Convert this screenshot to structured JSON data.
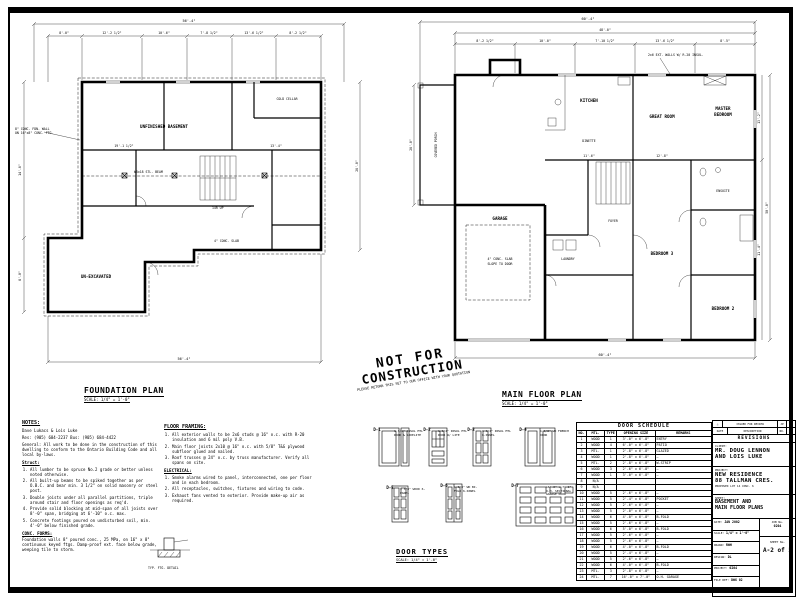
{
  "stamp": {
    "line1": "NOT FOR",
    "line2": "CONSTRUCTION",
    "sub": "PLEASE RETURN THIS SET TO OUR OFFICE WITH YOUR QUOTATION"
  },
  "foundation_plan": {
    "title": "FOUNDATION PLAN",
    "scale": "SCALE: 1/4\" = 1'-0\"",
    "dim_overall": "56'-4\"",
    "dim_left_top": "8'-0\"",
    "dims_top": [
      "12'-2 1/2\"",
      "10'-6\"",
      "7'-8 1/2\"",
      "13'-6 1/2\"",
      "8'-2 1/2\""
    ],
    "dim_left1": "14'-6\"",
    "dim_left2": "8'-0\"",
    "dim_right": "26'-0\"",
    "dim_bottom": "56'-4\"",
    "dims_in": [
      "19'-1 1/2\"",
      "13'-4\""
    ],
    "labels": {
      "basement": "UNFINISHED BASEMENT",
      "cold": "COLD CELLAR",
      "unexc": "UN-EXCAVATED",
      "fdn1": "8\" CONC. FDN. WALL",
      "fdn2": "ON 16\"x8\" CONC. FTG.",
      "beam": "W8x18 STL. BEAM",
      "stair": "14R UP",
      "slab": "4\" CONC. SLAB"
    }
  },
  "main_plan": {
    "title": "MAIN FLOOR PLAN",
    "scale": "SCALE: 1/4\" = 1'-0\"",
    "dim_overall": "60'-4\"",
    "dim_second": "48'-0\"",
    "dims_top": [
      "8'-2 1/2\"",
      "10'-0\"",
      "7'-10 1/2\"",
      "13'-6 1/2\"",
      "8'-5\""
    ],
    "dim_left": "26'-0\"",
    "dim_right": "50'-0\"",
    "dims_right_in": [
      "13'-2\"",
      "11'-4\""
    ],
    "dim_bottom": "60'-4\"",
    "dims_in": [
      "11'-6\"",
      "12'-8\""
    ],
    "labels": {
      "garage": "GARAGE",
      "kitchen": "KITCHEN",
      "dinette": "DINETTE",
      "great": "GREAT ROOM",
      "master1": "MASTER",
      "master2": "BEDROOM",
      "ens": "ENSUITE",
      "bed2": "BEDROOM 2",
      "bed3": "BEDROOM 3",
      "laun": "LAUNDRY",
      "foyer": "FOYER",
      "porch": "COVERED PORCH",
      "slab1": "4\" CONC. SLAB",
      "slab2": "SLOPE TO DOOR",
      "wall_note": "2x6 EXT. WALLS W/ R-20 INSUL."
    }
  },
  "notes": {
    "heading": "NOTES:",
    "intro1": "Dave Lukacs & Lois Luke",
    "intro2": "Res: (905) 684-2237   Bus: (905) 684-4422",
    "general": "General:  All work to be done in the construction of this dwelling to conform to the Ontario Building Code and all local by-laws.",
    "struct_label": "Struct:",
    "items": [
      "All lumber to be spruce No.2 grade or better unless noted otherwise.",
      "All built-up beams to be spiked together as per O.B.C. and bear min. 3 1/2\" on solid masonry or steel post.",
      "Double joists under all parallel partitions, triple around stair and floor openings as req'd.",
      "Provide solid blocking at mid-span of all joists over 8'-0\" span, bridging at 6'-10\" o.c. max.",
      "Concrete footings poured on undisturbed soil, min. 4'-0\" below finished grade."
    ],
    "forms_label": "CONC. FORMS:",
    "forms": "Foundation walls 8\" poured conc., 25 MPa, on 16\" x 8\" continuous keyed ftgs. Damp-proof ext. face below grade, weeping tile to storm."
  },
  "notes2": {
    "heading": "FLOOR FRAMING:",
    "items": [
      "All exterior walls to be 2x6 studs @ 16\" o.c. with R-20 insulation and 6 mil poly V.B.",
      "Main floor joists 2x10 @ 16\" o.c. with 5/8\" T&G plywood subfloor glued and nailed.",
      "Roof trusses @ 24\" o.c. by truss manufacturer. Verify all spans on site."
    ],
    "elec_label": "ELECTRICAL:",
    "elec_items": [
      "Smoke alarms wired to panel, interconnected, one per floor and in each bedroom.",
      "All receptacles, switches, fixtures and wiring to code.",
      "Exhaust fans vented to exterior. Provide make-up air as required."
    ],
    "detail_label": "TYP. FTG. DETAIL"
  },
  "door_types": {
    "title": "DOOR TYPES",
    "scale": "SCALE: 1/4\" = 1'-0\"",
    "doors": [
      {
        "id": "D-1",
        "note": "1 3/4\" INSUL MTL DOOR & SIDELITE"
      },
      {
        "id": "D-2",
        "note": "1 3/4\" INSUL MTL DOOR W/ LITE"
      },
      {
        "id": "D-3",
        "note": "1 3/4\" INSUL MTL 6-PANEL"
      },
      {
        "id": "D-4",
        "note": "1 3/8\" WD FRENCH DOOR"
      },
      {
        "id": "D-5",
        "note": "1 3/8\" WOOD 6-PANEL"
      },
      {
        "id": "D-6",
        "note": "1 3/8\" WD BI-FOLD 6-PANEL"
      },
      {
        "id": "D-7",
        "note": "16'-0\" x 7'-0\" O.H. SECTIONAL GARAGE DOOR"
      }
    ]
  },
  "door_schedule": {
    "title": "DOOR SCHEDULE",
    "columns": [
      "NO.",
      "MTL.",
      "TYPE",
      "OPENING SIZE",
      "REMARKS"
    ],
    "rows": [
      {
        "no": "1",
        "mtl": "WOOD",
        "type": "1",
        "size": "3'-0\" x 6'-8\"",
        "remarks": "ENTRY"
      },
      {
        "no": "2",
        "mtl": "WOOD",
        "type": "4",
        "size": "6'-0\" x 6'-8\"",
        "remarks": "PATIO"
      },
      {
        "no": "3",
        "mtl": "MTL.",
        "type": "1",
        "size": "2'-8\" x 6'-8\"",
        "remarks": "GLAZED"
      },
      {
        "no": "4",
        "mtl": "WOOD",
        "type": "1",
        "size": "2'-8\" x 6'-8\"",
        "remarks": "—"
      },
      {
        "no": "5",
        "mtl": "MTL.",
        "type": "2",
        "size": "2'-8\" x 6'-8\"",
        "remarks": "W-STRIP"
      },
      {
        "no": "6",
        "mtl": "WOOD",
        "type": "3",
        "size": "2'-6\" x 6'-8\"",
        "remarks": "—"
      },
      {
        "no": "7",
        "mtl": "WOOD",
        "type": "1",
        "size": "3'-0\" x 6'-8\"",
        "remarks": "—"
      },
      {
        "no": "8",
        "mtl": "N/A",
        "type": "",
        "size": "",
        "remarks": ""
      },
      {
        "no": "9",
        "mtl": "N/A",
        "type": "",
        "size": "",
        "remarks": ""
      },
      {
        "no": "10",
        "mtl": "WOOD",
        "type": "5",
        "size": "2'-6\" x 6'-8\"",
        "remarks": "—"
      },
      {
        "no": "11",
        "mtl": "WOOD",
        "type": "5",
        "size": "2'-4\" x 6'-8\"",
        "remarks": "POCKET"
      },
      {
        "no": "12",
        "mtl": "WOOD",
        "type": "5",
        "size": "2'-6\" x 6'-8\"",
        "remarks": "—"
      },
      {
        "no": "13",
        "mtl": "WOOD",
        "type": "5",
        "size": "2'-0\" x 6'-8\"",
        "remarks": "—"
      },
      {
        "no": "14",
        "mtl": "WOOD",
        "type": "6",
        "size": "4'-0\" x 6'-8\"",
        "remarks": "B-FOLD"
      },
      {
        "no": "15",
        "mtl": "WOOD",
        "type": "5",
        "size": "2'-6\" x 6'-8\"",
        "remarks": "—"
      },
      {
        "no": "16",
        "mtl": "WOOD",
        "type": "6",
        "size": "5'-0\" x 6'-8\"",
        "remarks": "B-FOLD"
      },
      {
        "no": "17",
        "mtl": "WOOD",
        "type": "5",
        "size": "2'-6\" x 6'-8\"",
        "remarks": "—"
      },
      {
        "no": "18",
        "mtl": "WOOD",
        "type": "5",
        "size": "2'-6\" x 6'-8\"",
        "remarks": "—"
      },
      {
        "no": "19",
        "mtl": "WOOD",
        "type": "6",
        "size": "4'-0\" x 6'-8\"",
        "remarks": "B-FOLD"
      },
      {
        "no": "20",
        "mtl": "WOOD",
        "type": "5",
        "size": "2'-4\" x 6'-8\"",
        "remarks": "—"
      },
      {
        "no": "21",
        "mtl": "WOOD",
        "type": "5",
        "size": "2'-6\" x 6'-8\"",
        "remarks": "—"
      },
      {
        "no": "22",
        "mtl": "WOOD",
        "type": "6",
        "size": "4'-0\" x 6'-8\"",
        "remarks": "B-FOLD"
      },
      {
        "no": "23",
        "mtl": "MTL.",
        "type": "3",
        "size": "2'-8\" x 6'-8\"",
        "remarks": "—"
      },
      {
        "no": "24",
        "mtl": "MTL.",
        "type": "7",
        "size": "16'-0\" x 7'-0\"",
        "remarks": "O.H. GARAGE"
      }
    ]
  },
  "title_block": {
    "rev_issue": "ISSUED FOR REVIEW",
    "rev_c1": "JP",
    "rev_c2": "CP",
    "rev_h1": "DATE",
    "rev_h2": "DESCRIPTION",
    "rev_h3": "NO.",
    "rev_h4": "BY",
    "revisions_label": "REVISIONS",
    "client_label": "CLIENT:",
    "client_line1": "MR. DOUG LENNON",
    "client_line2": "AND LOIS LUKE",
    "project_label": "PROJECT:",
    "project_line1": "NEW RESIDENCE",
    "project_line2": "88 TALLMAN CRES.",
    "project_line3": "PROPOSED   LOT 14   CONC. 6",
    "sheet_label": "SHEET:",
    "sheet_line1": "BASEMENT AND",
    "sheet_line2": "MAIN FLOOR PLANS",
    "fields": [
      {
        "label": "DATE:",
        "value": "JAN 2002"
      },
      {
        "label": "SCALE:",
        "value": "1/4\" = 1'-0\""
      },
      {
        "label": "DRAWN:",
        "value": "RWH"
      },
      {
        "label": "DESIGN:",
        "value": "DL"
      },
      {
        "label": "PROJECT:",
        "value": "0204"
      },
      {
        "label": "FILE REF:",
        "value": "DWG 02"
      }
    ],
    "job_label": "JOB No.",
    "job_no": "0204",
    "sheet_no_label": "SHEET No.",
    "sheet_no": "A-2 of 5"
  }
}
